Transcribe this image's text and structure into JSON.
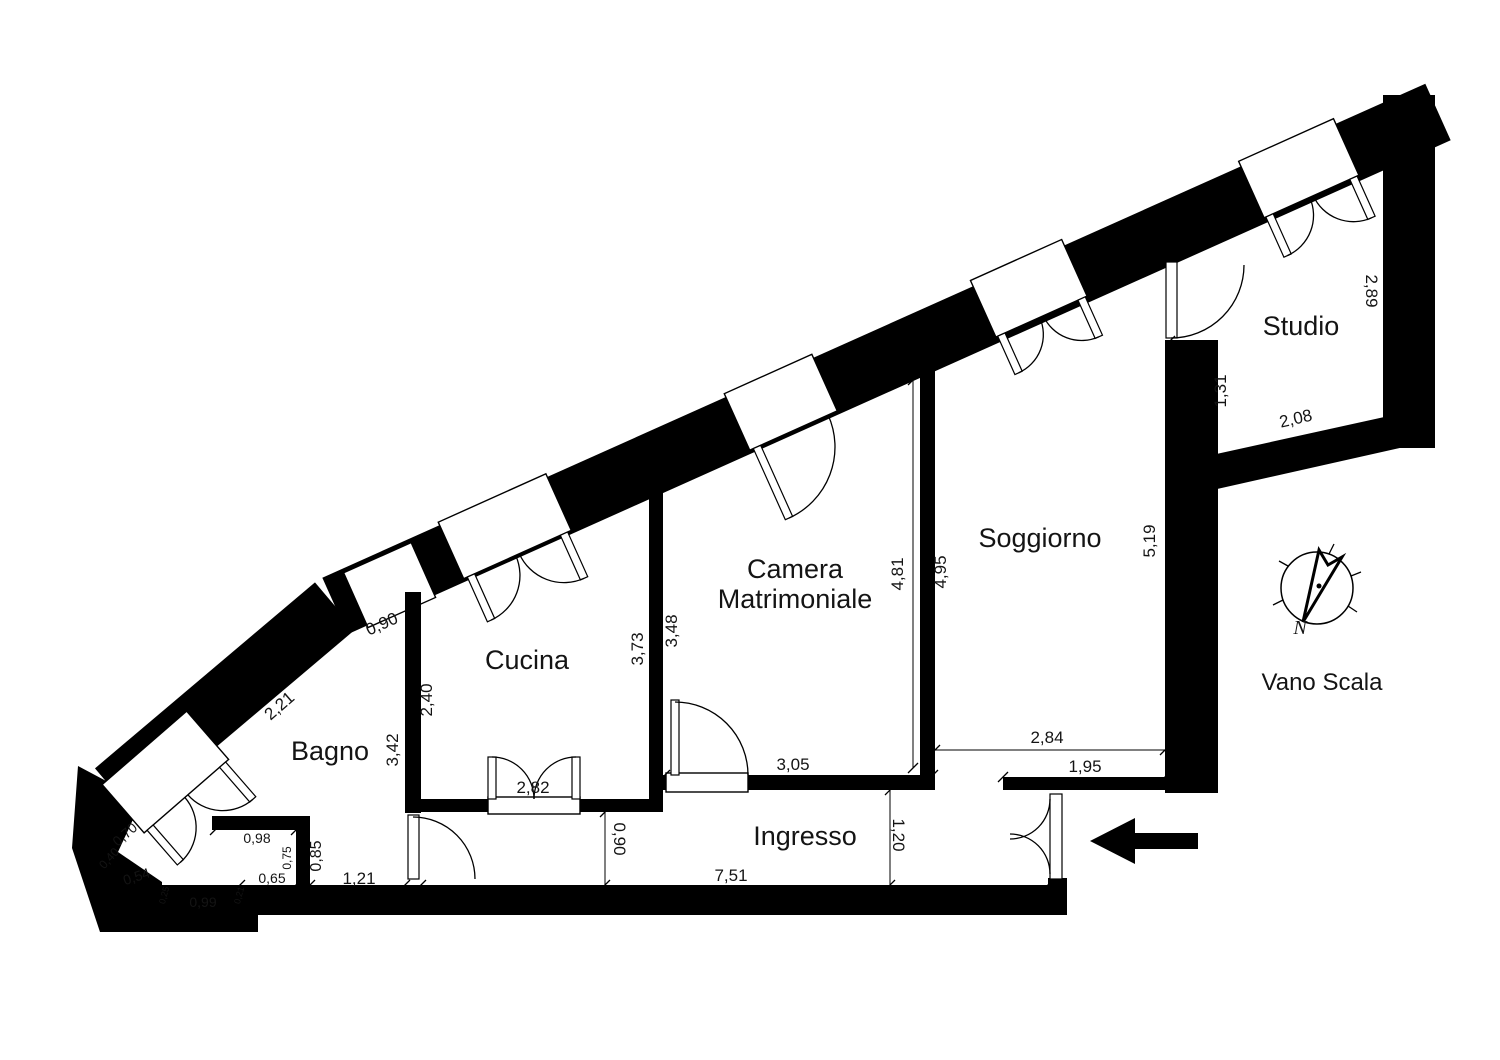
{
  "plan": {
    "background": "#ffffff",
    "wall_color": "#000000",
    "rooms": {
      "bagno": "Bagno",
      "cucina": "Cucina",
      "camera_line1": "Camera",
      "camera_line2": "Matrimoniale",
      "soggiorno": "Soggiorno",
      "ingresso": "Ingresso",
      "studio": "Studio",
      "vano_scala": "Vano Scala"
    },
    "compass": {
      "north_label": "N"
    },
    "dims": {
      "bagno_diag": "2,21",
      "bagno_window": "0,90",
      "bagno_right": "3,42",
      "cucina_left": "2,40",
      "cucina_right": "3,73",
      "camera_left": "3,48",
      "camera_right": "4,81",
      "camera_right_out": "4,95",
      "camera_bottom": "3,05",
      "soggiorno_right": "5,19",
      "soggiorno_bottom": "2,84",
      "soggiorno_wall": "1,95",
      "studio_left": "1,31",
      "studio_right": "2,89",
      "studio_bottom": "2,08",
      "cucina_door": "2,82",
      "ingresso_left": "0,90",
      "ingresso_right": "1,20",
      "ingresso_bottom": "7,51",
      "bagno_1_21": "1,21",
      "niche_top": "0,98",
      "niche_right_in": "0,75",
      "niche_right_out": "0,85",
      "niche_bottom": "0,65",
      "bagno_bottom": "0,99",
      "step_left": "0,25",
      "step_right": "0,21",
      "corner_diag": "0,54",
      "corner_low": "0,40",
      "corner_high": "0,70"
    }
  }
}
